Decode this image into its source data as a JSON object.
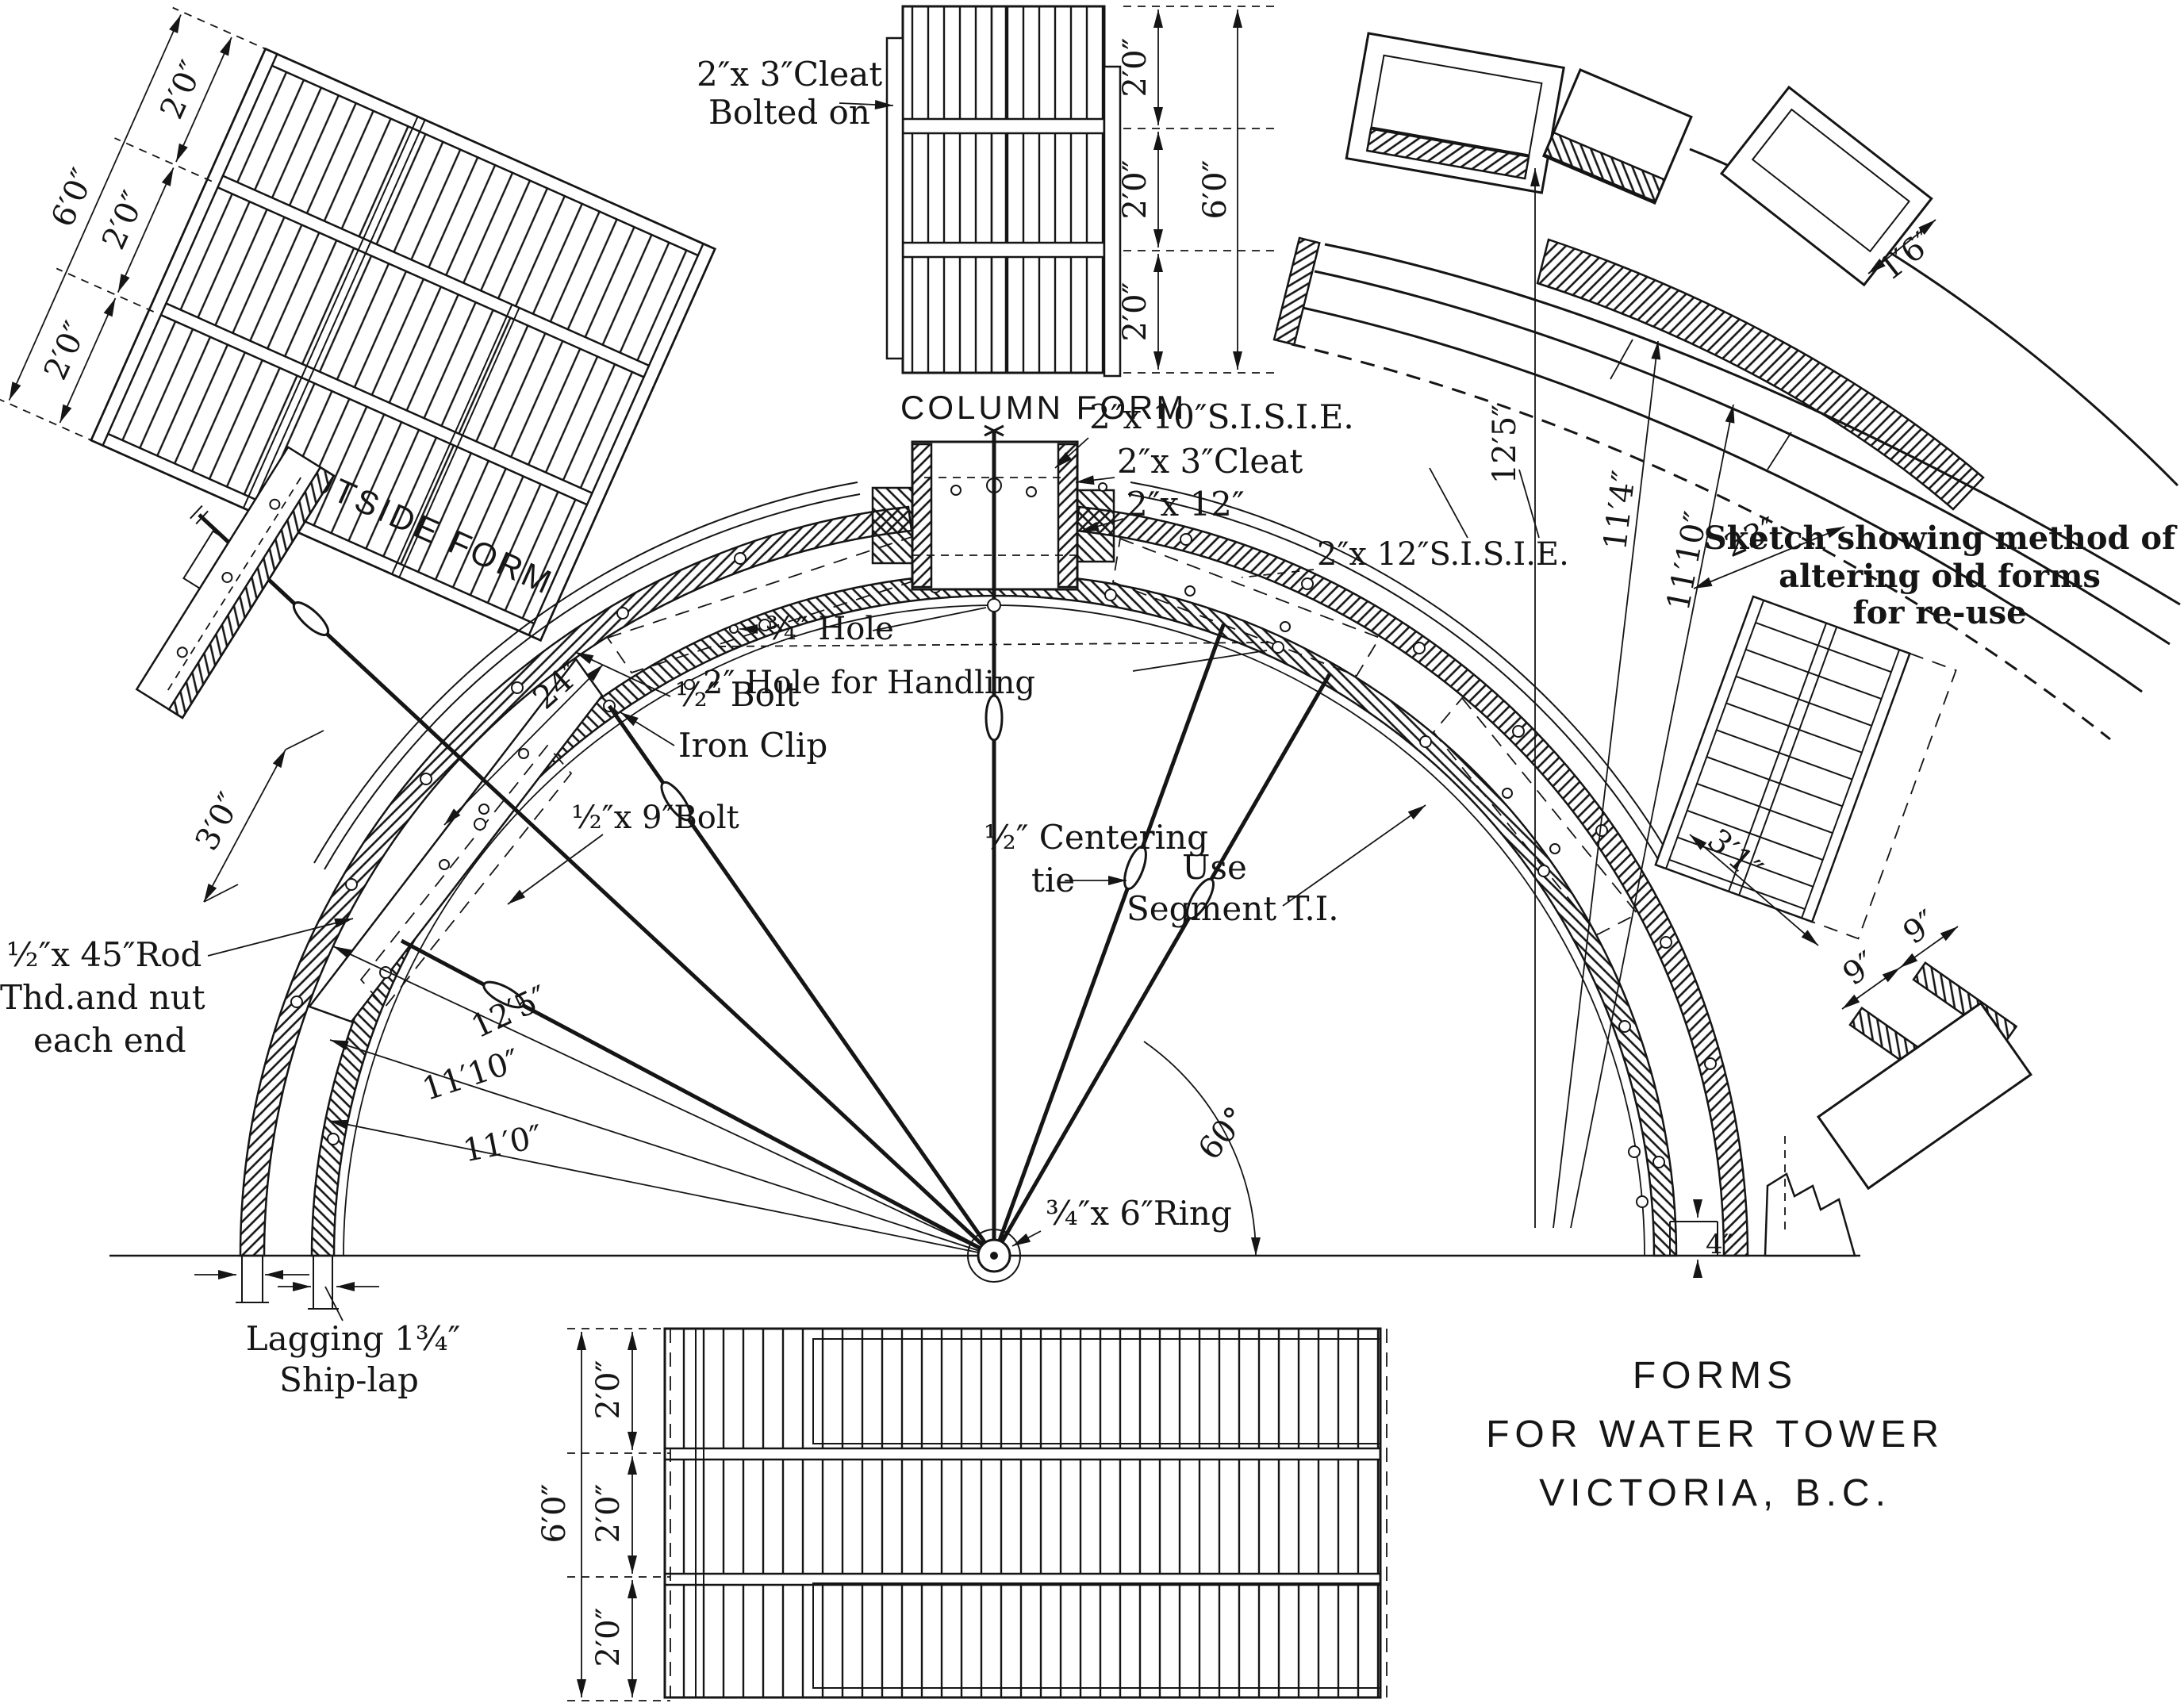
{
  "title_block": {
    "line1": "FORMS",
    "line2": "FOR WATER TOWER",
    "line3": "VICTORIA, B.C."
  },
  "outside_form": {
    "name": "OUTSIDE FORM",
    "seg1": "2′0″",
    "seg2": "2′0″",
    "seg3": "2′0″",
    "total": "6′0″"
  },
  "column_form": {
    "name": "COLUMN FORM",
    "cleat_note1": "2″x 3″Cleat",
    "cleat_note2": "Bolted on",
    "seg1": "2′0″",
    "seg2": "2′0″",
    "seg3": "2′0″",
    "total": "6′0″"
  },
  "plan": {
    "sisie_2x10": "2″x 10″S.I.S.I.E.",
    "cleat_2x3": "2″x 3″Cleat",
    "plank_2x12": "2″x 12″",
    "sisie_2x12": "2″x 12″S.I.S.I.E.",
    "hole_small": "¾″ Hole",
    "hole_handling": "2″ Hole for Handling",
    "bolt_half": "½″ Bolt",
    "iron_clip": "Iron Clip",
    "bolt_9": "½″x 9″Bolt",
    "dim_24": "24″",
    "centering1": "½″ Centering",
    "centering2": "tie",
    "use_segment1": "Use",
    "use_segment2": "Segment T.I.",
    "angle_60": "60°",
    "ring": "¾″x 6″Ring",
    "radius_outer": "12′5″",
    "radius_mid": "11′10″",
    "radius_inner": "11′0″",
    "rod1": "½″x 45″Rod",
    "rod2": "Thd.and nut",
    "rod3": "each end",
    "dim_3ft": "3′0″",
    "lagging1": "Lagging 1¾″",
    "lagging2": "Ship-lap",
    "dim_4in": "4″"
  },
  "reuse_sketch": {
    "caption1": "Sketch showing method of",
    "caption2": "altering old forms",
    "caption3": "for re-use",
    "r1": "12′5″",
    "r2": "11′4″",
    "r3": "11′10″",
    "d_1ft6": "1′6″",
    "d_23": "23″",
    "d_3ft1": "3′1″",
    "d_9a": "9″",
    "d_9b": "9″"
  },
  "bottom_form": {
    "seg1": "2′0″",
    "seg2": "2′0″",
    "seg3": "2′0″",
    "total": "6′0″"
  }
}
